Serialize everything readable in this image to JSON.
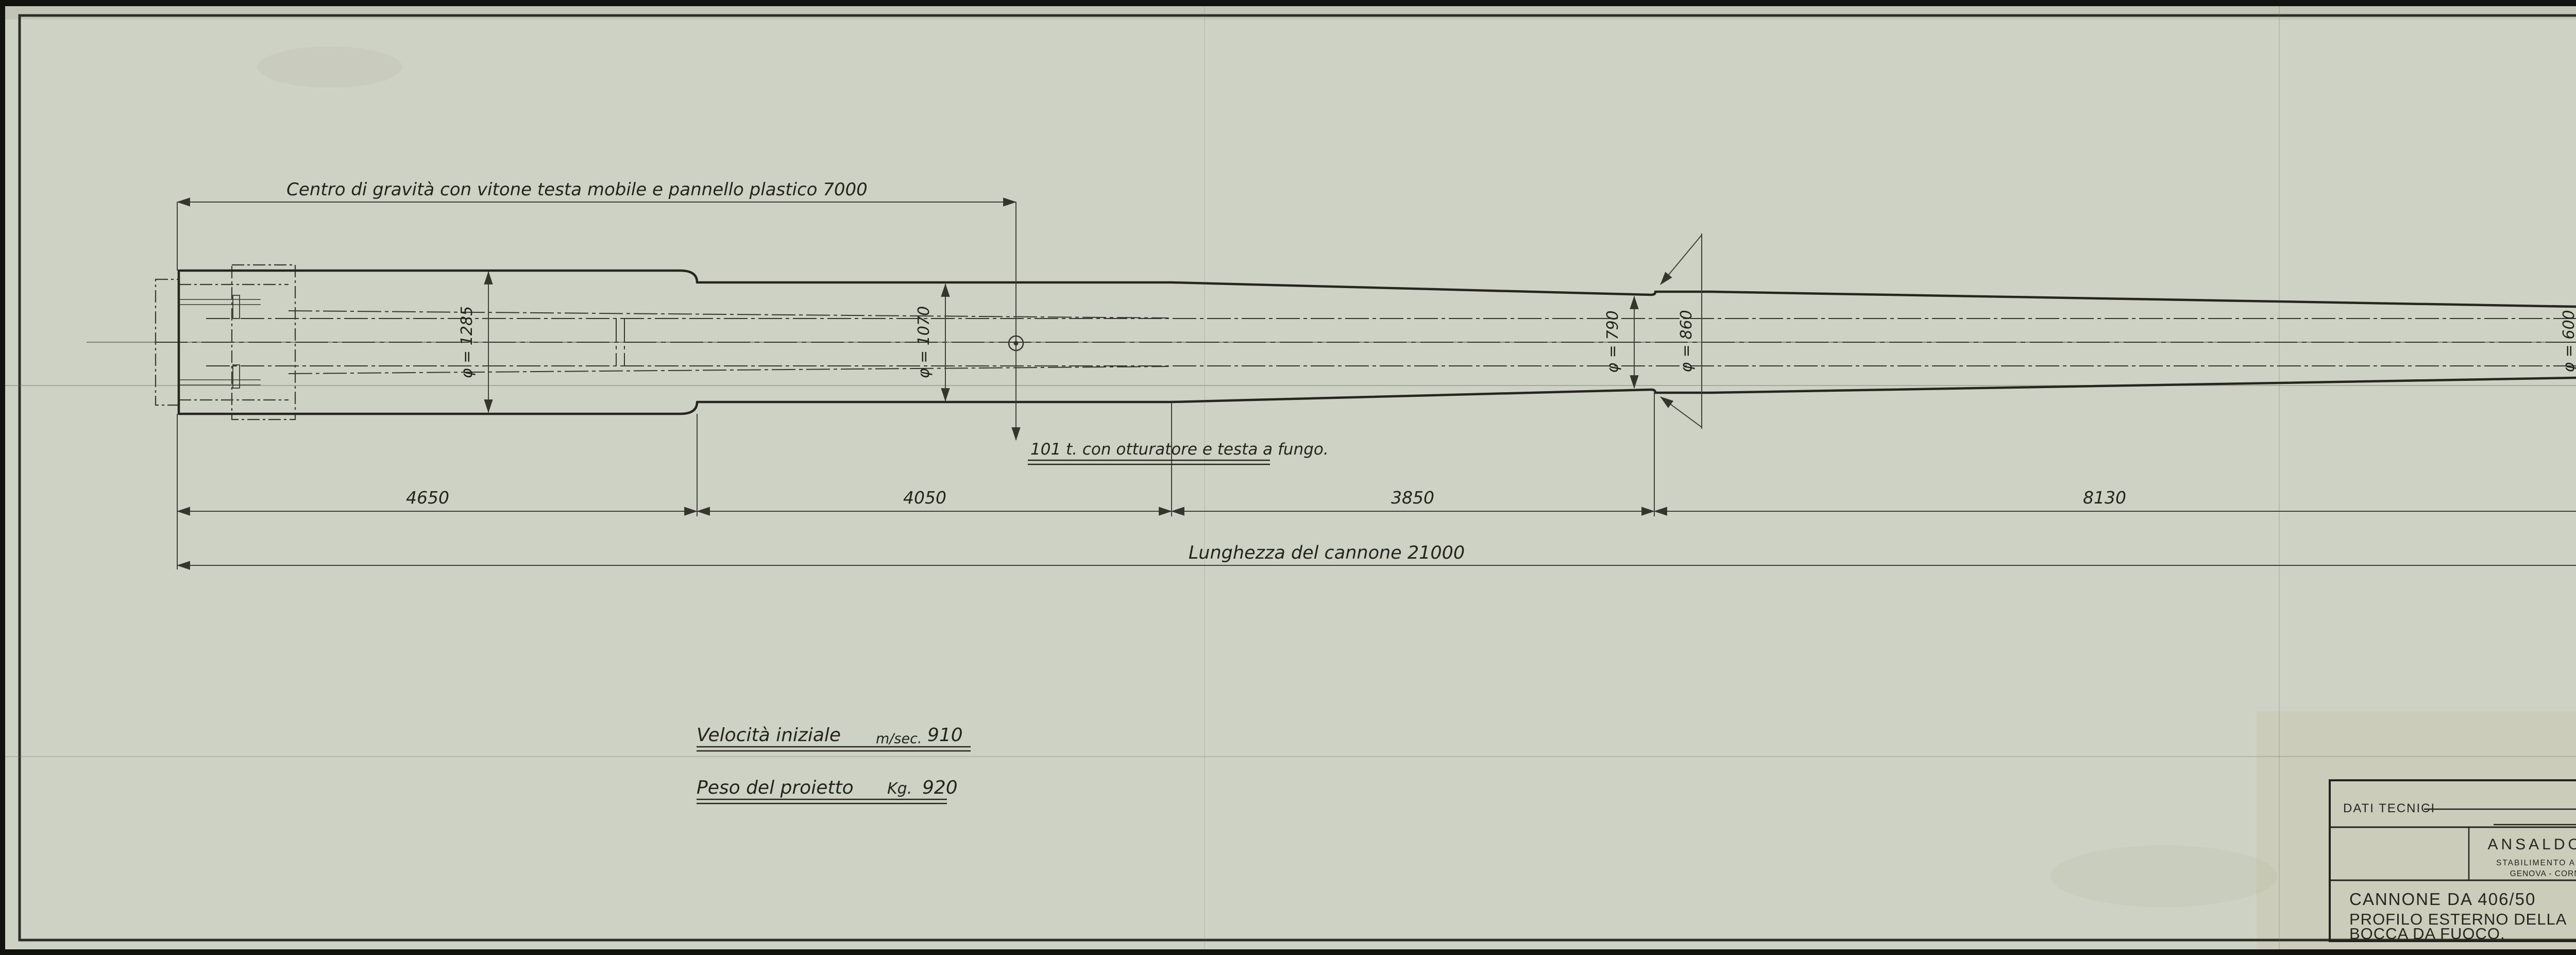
{
  "sheet": {
    "paper_color": "#ced2c4",
    "line_color": "#2b2b24",
    "ink_color": "#24241c"
  },
  "annotations": {
    "cg_dimension": "Centro di gravità con vitone testa mobile e pannello plastico 7000",
    "cg_weight_note": "101 t. con otturatore e testa a fungo.",
    "overall_length": "Lunghezza del cannone 21000"
  },
  "dimensions": {
    "segments": [
      "4650",
      "4050",
      "3850",
      "8130",
      "320"
    ]
  },
  "diameters": [
    "φ = 1285",
    "φ = 1070",
    "φ = 790",
    "φ = 860",
    "φ = 600",
    "φ = 650"
  ],
  "tech_data": {
    "velocity_label": "Velocità iniziale",
    "velocity_unit": "m/sec.",
    "velocity_value": "910",
    "projectile_label": "Peso del proietto",
    "projectile_unit": "Kg.",
    "projectile_value": "920"
  },
  "title_block": {
    "dati_tecnici": "DATI TECNICI",
    "company": "ANSALDO  S. A.",
    "plant": "STABILIMENTO   ARTIGLIERIE",
    "location": "GENOVA - CORNIGLIANO",
    "scala_label": "SCALA",
    "scala_value": "1:20",
    "approvals": [
      {
        "label": "DIS.",
        "date": "20.6.36"
      },
      {
        "label": "LUC.",
        "date": "20.7.39"
      },
      {
        "label": "CONTR.",
        "date": ""
      },
      {
        "label": "VISTO",
        "date": ""
      }
    ],
    "title_line1": "CANNONE  DA  406/50",
    "title_line2": "PROFILO  ESTERNO  DELLA",
    "title_line3": "BOCCA  DA  FUOCO.",
    "drawing_number": "A.32414"
  }
}
